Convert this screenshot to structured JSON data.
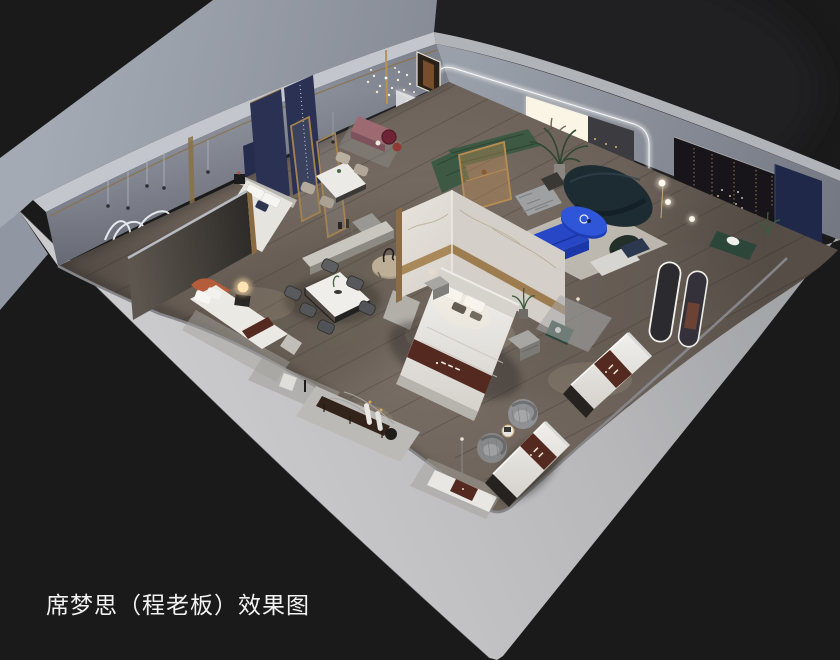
{
  "image": {
    "type": "3d-interior-showroom-render",
    "view": "isometric-cutaway-floorplan",
    "width_px": 840,
    "height_px": 660
  },
  "caption": {
    "text": "席梦思（程老板）效果图"
  },
  "colors": {
    "background": "#1a1a1a",
    "outer_wall_face": "#99a0ab",
    "wall_top_band": "#c3c6cc",
    "front_cut_wall": "#c2c2c5",
    "inner_wall_face": "#8e93a0",
    "floor_wood": "#766c63",
    "rug_light": "#b3b1ac",
    "stone_platform": "#bcbab6",
    "marble_white": "#dcd8d2",
    "gold_trim": "#a9885a",
    "sofa_green": "#3d5944",
    "sofa_navy": "#1d2b33",
    "table_blue": "#2f55d8",
    "bench_blue": "#2847c6",
    "panel_navy": "#2b3152",
    "display_wall_dark": "#17151a",
    "mattress_white": "#e9e7e3",
    "runner_maroon": "#54291f",
    "headboard_terracotta": "#b55c3a",
    "bench_mauve": "#9c6a70",
    "accent_red": "#6e2436",
    "bench_green": "#2c463a",
    "chair_fuzzy_gray": "#909194",
    "walnut_dark": "#33241b",
    "lamp_glow": "#ffdfa8",
    "led_white": "#ffffff"
  },
  "scene": {
    "objects": [
      "back-left-wall",
      "back-right-wall",
      "front-cutaway-walls",
      "wood-floor",
      "wall-art-squiggle",
      "pendant-cord-lights",
      "dot-chandelier",
      "doorway-mirror",
      "white-arch-partition",
      "navy-headboard-panels",
      "gold-glass-partitions",
      "bed-navy-vignette",
      "dark-partition",
      "bed-terracotta-vignette",
      "glow-orb-lamp",
      "dining-set-four-chairs",
      "dining-set-six-chairs",
      "sideboard-console",
      "round-wood-table",
      "mauve-bench",
      "red-side-tables",
      "marble-partition-wall",
      "main-display-bed",
      "nightstands",
      "living-area-rug",
      "green-sectional-sofa",
      "gold-screen-panel",
      "palm-plant",
      "navy-curved-sofa",
      "blue-oval-coffee-table",
      "blue-media-bench",
      "knit-pouf",
      "black-shell-chair",
      "glowing-window-panel",
      "led-arch-light",
      "dark-display-wall",
      "string-lights",
      "navy-accent-panel",
      "green-bench",
      "arch-mirrors",
      "sphere-floor-lamps",
      "stone-display-platform",
      "walnut-bench",
      "cylinder-floor-lamps",
      "mattress-display-center",
      "mattress-display-right",
      "mattress-display-left",
      "fuzzy-swivel-chairs",
      "side-table",
      "display-rugs",
      "caption-text"
    ]
  }
}
